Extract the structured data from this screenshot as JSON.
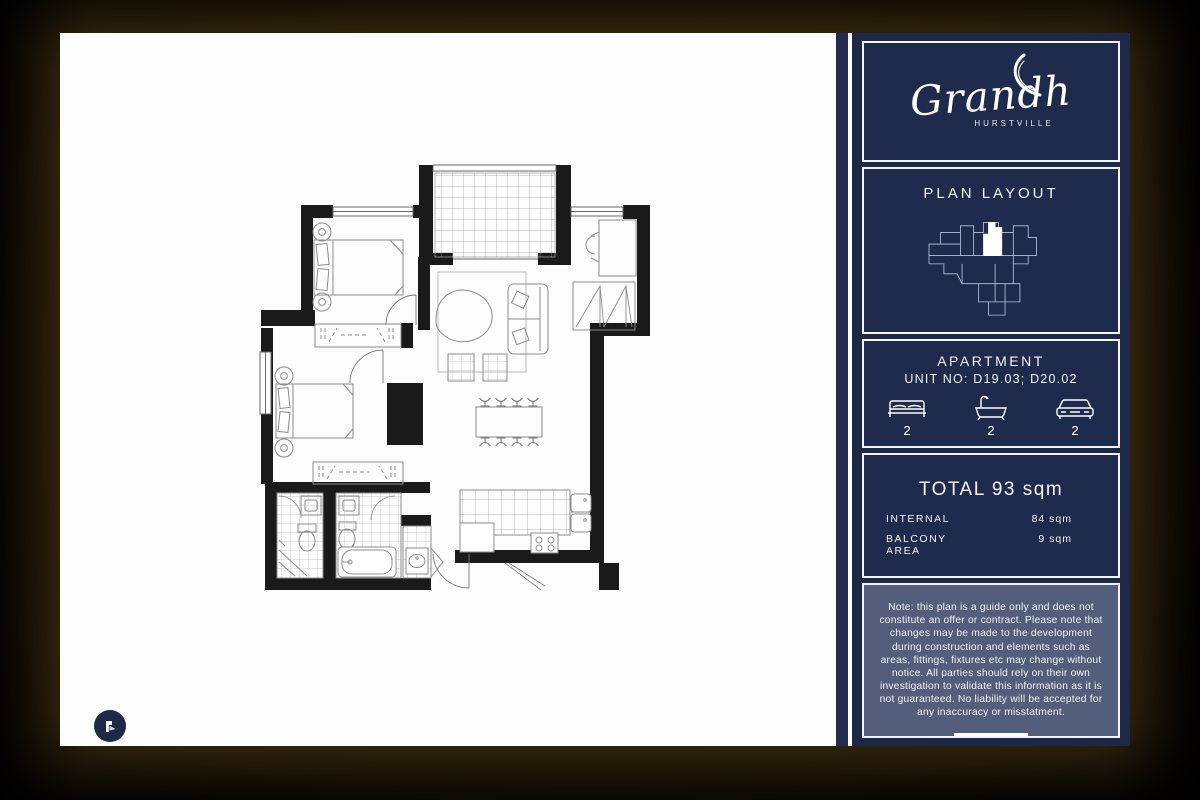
{
  "colors": {
    "navy": "#1f2b4d",
    "sidebar_outer": "#1c2845",
    "note_bg": "#525e7a",
    "page_bg": "#fdfdfd",
    "wall": "#1a1a1a",
    "frame_white": "#f3f4f7"
  },
  "sidebar": {
    "logo": {
      "name": "Grandh",
      "location": "HURSTVILLE"
    },
    "plan_layout": {
      "title": "PLAN LAYOUT"
    },
    "apartment": {
      "title": "APARTMENT",
      "unit_line": "UNIT NO: D19.03; D20.02",
      "features": [
        {
          "icon": "bed-icon",
          "count": "2"
        },
        {
          "icon": "bath-icon",
          "count": "2"
        },
        {
          "icon": "car-icon",
          "count": "2"
        }
      ]
    },
    "area": {
      "total": "TOTAL 93 sqm",
      "rows": [
        {
          "label": "INTERNAL",
          "value": "84 sqm"
        },
        {
          "label": "BALCONY AREA",
          "value": "9 sqm"
        }
      ]
    },
    "note": "Note: this plan is a guide only and does not constitute an offer or contract. Please note that changes may be made to the development during construction and elements such as areas, fittings, fixtures etc may change without notice. All parties should rely on their own investigation to validate this information as it is not guaranteed. No liability will be accepted for any inaccuracy or misstatment."
  }
}
